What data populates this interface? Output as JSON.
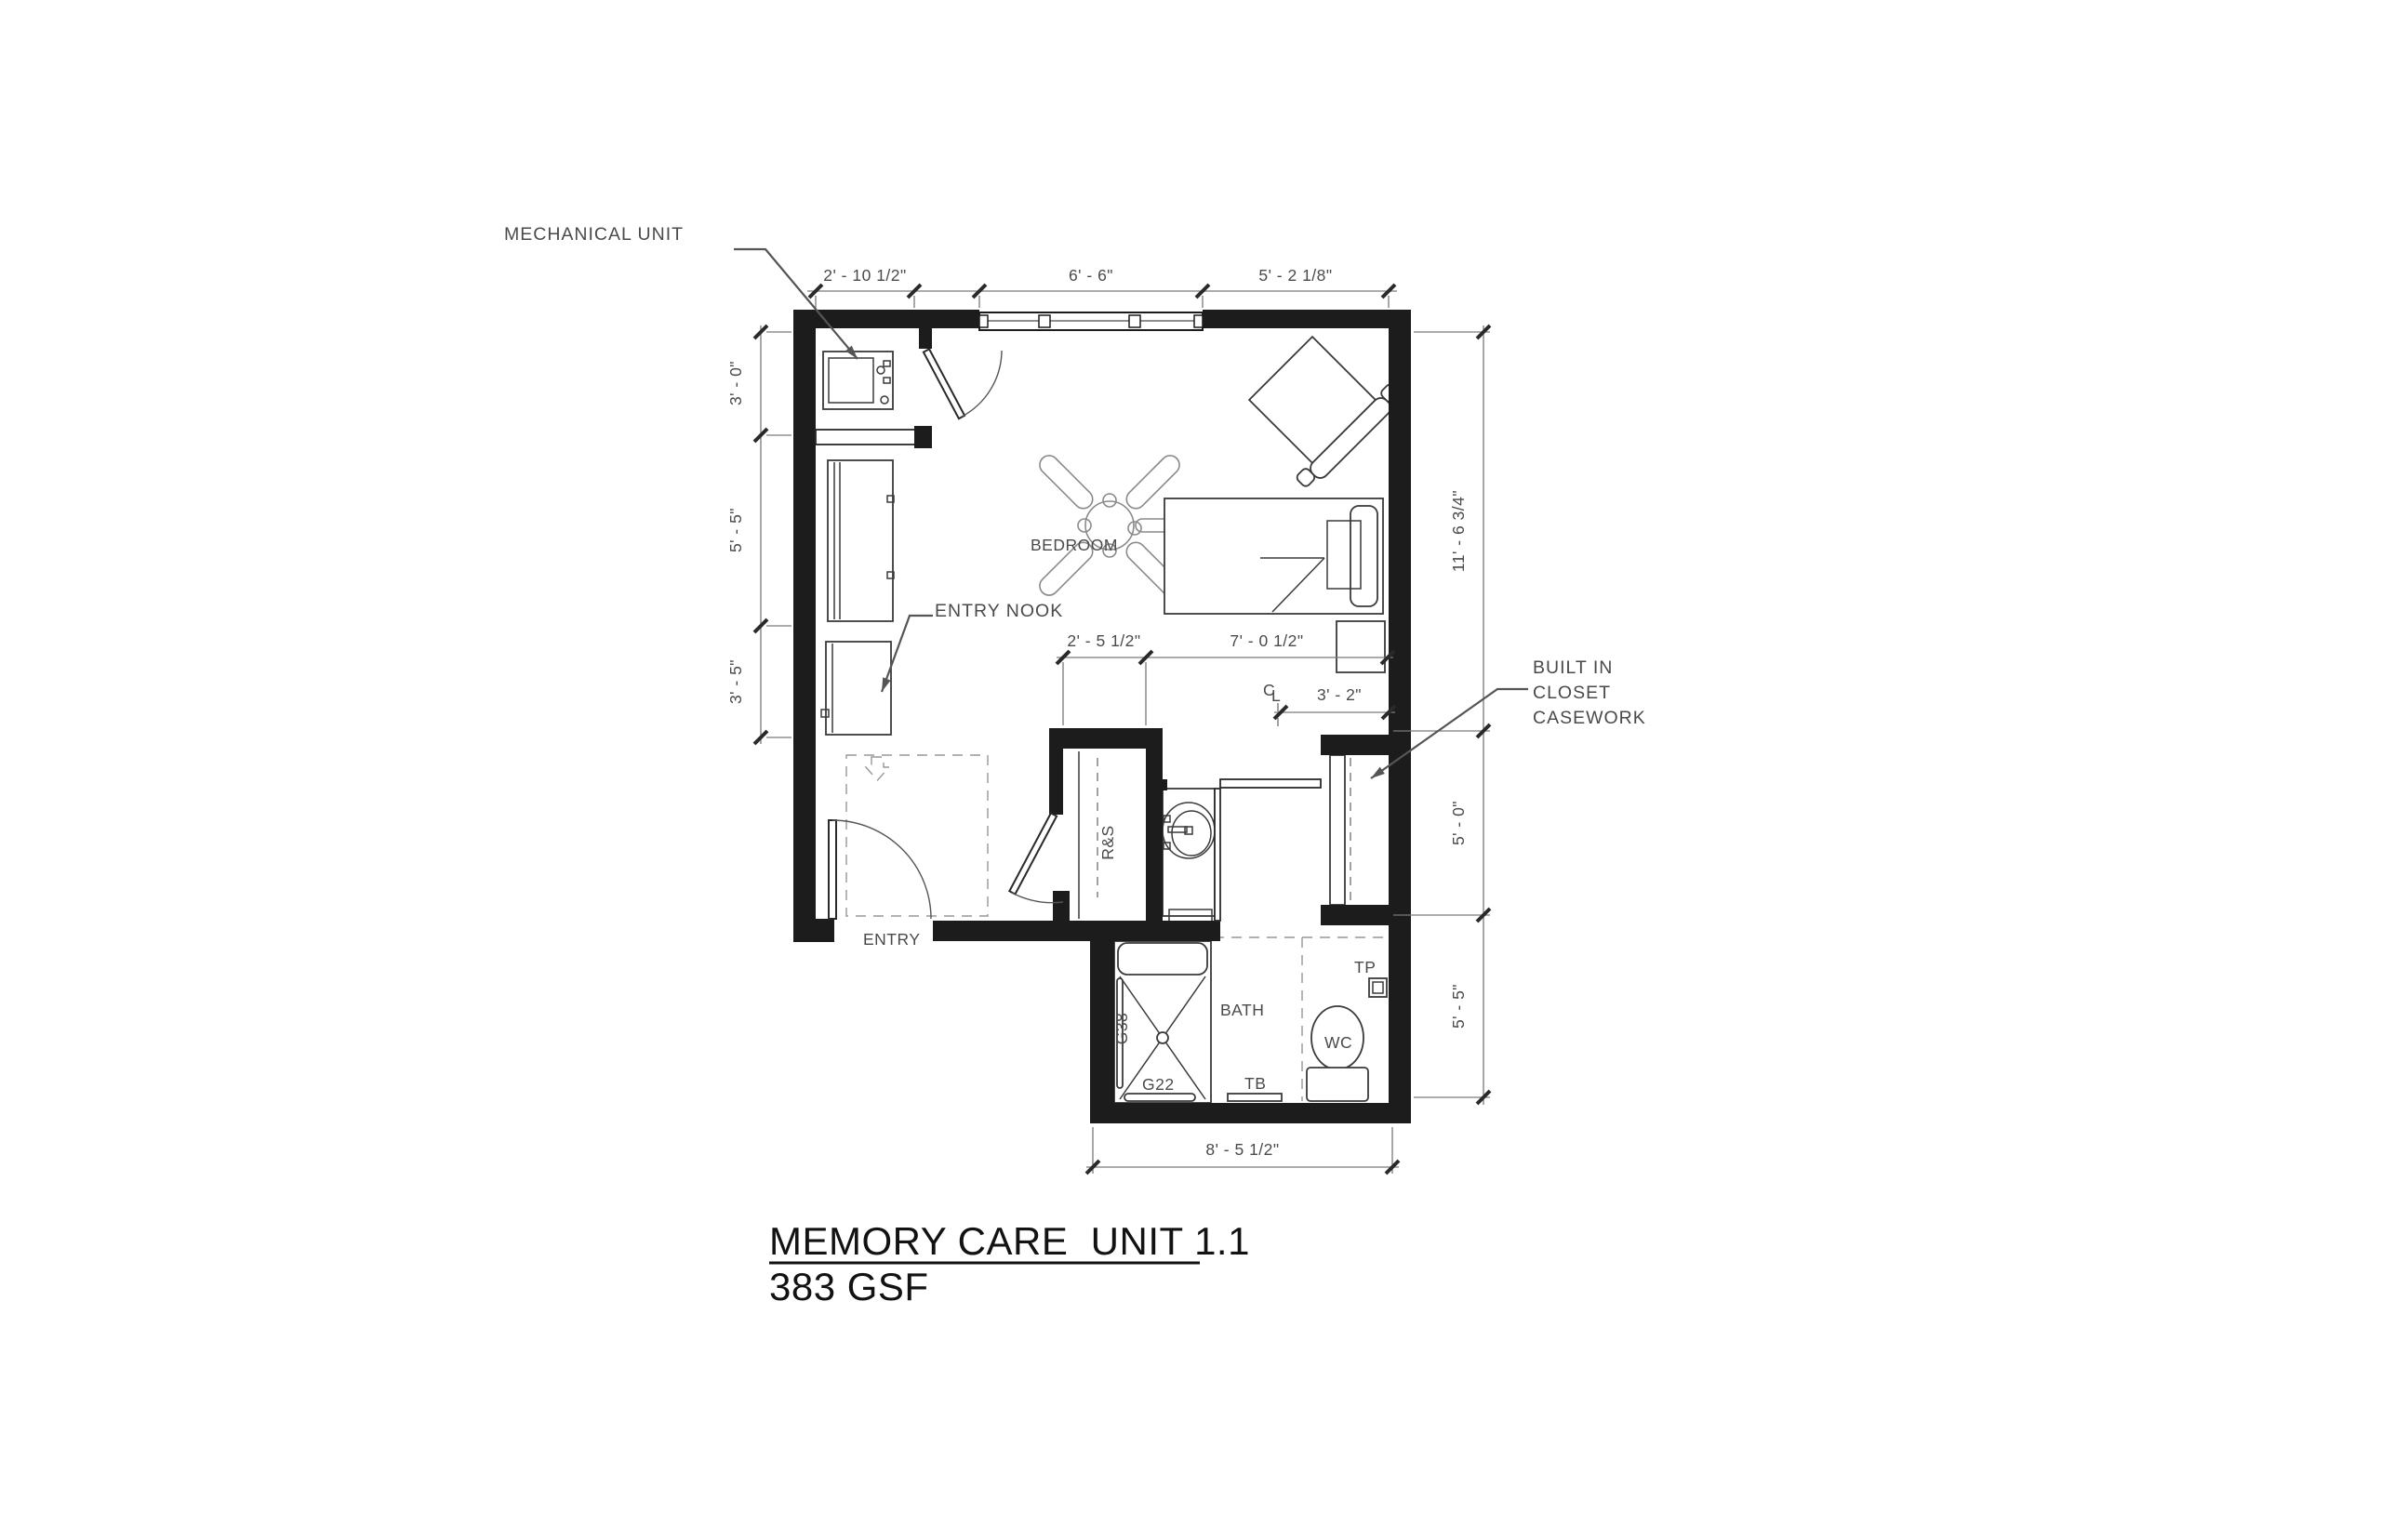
{
  "drawing": {
    "title": "MEMORY CARE  UNIT 1.1",
    "subtitle": "383 GSF"
  },
  "labels": {
    "mechanical_unit": "MECHANICAL UNIT",
    "entry_nook": "ENTRY NOOK",
    "built_in_1": "BUILT IN",
    "built_in_2": "CLOSET",
    "built_in_3": "CASEWORK",
    "bedroom": "BEDROOM",
    "entry": "ENTRY",
    "bath": "BATH",
    "rs": "R&S",
    "g38": "G38",
    "g22": "G22",
    "tb": "TB",
    "wc": "WC",
    "tp": "TP",
    "cl_c": "C",
    "cl_l": "L"
  },
  "dimensions": {
    "top_mech": "2' - 10 1/2\"",
    "top_window": "6' - 6\"",
    "top_right": "5' - 2 1/8\"",
    "left_upper": "3' - 0\"",
    "left_middle": "5' - 5\"",
    "left_lower": "3' - 5\"",
    "right_bedroom": "11' - 6 3/4\"",
    "right_closet": "5' - 0\"",
    "right_bath": "5' - 5\"",
    "closet_width": "2' - 5 1/2\"",
    "closet_zone": "7' - 0 1/2\"",
    "cl_offset": "3' - 2\"",
    "bottom_bath": "8' - 5 1/2\""
  }
}
